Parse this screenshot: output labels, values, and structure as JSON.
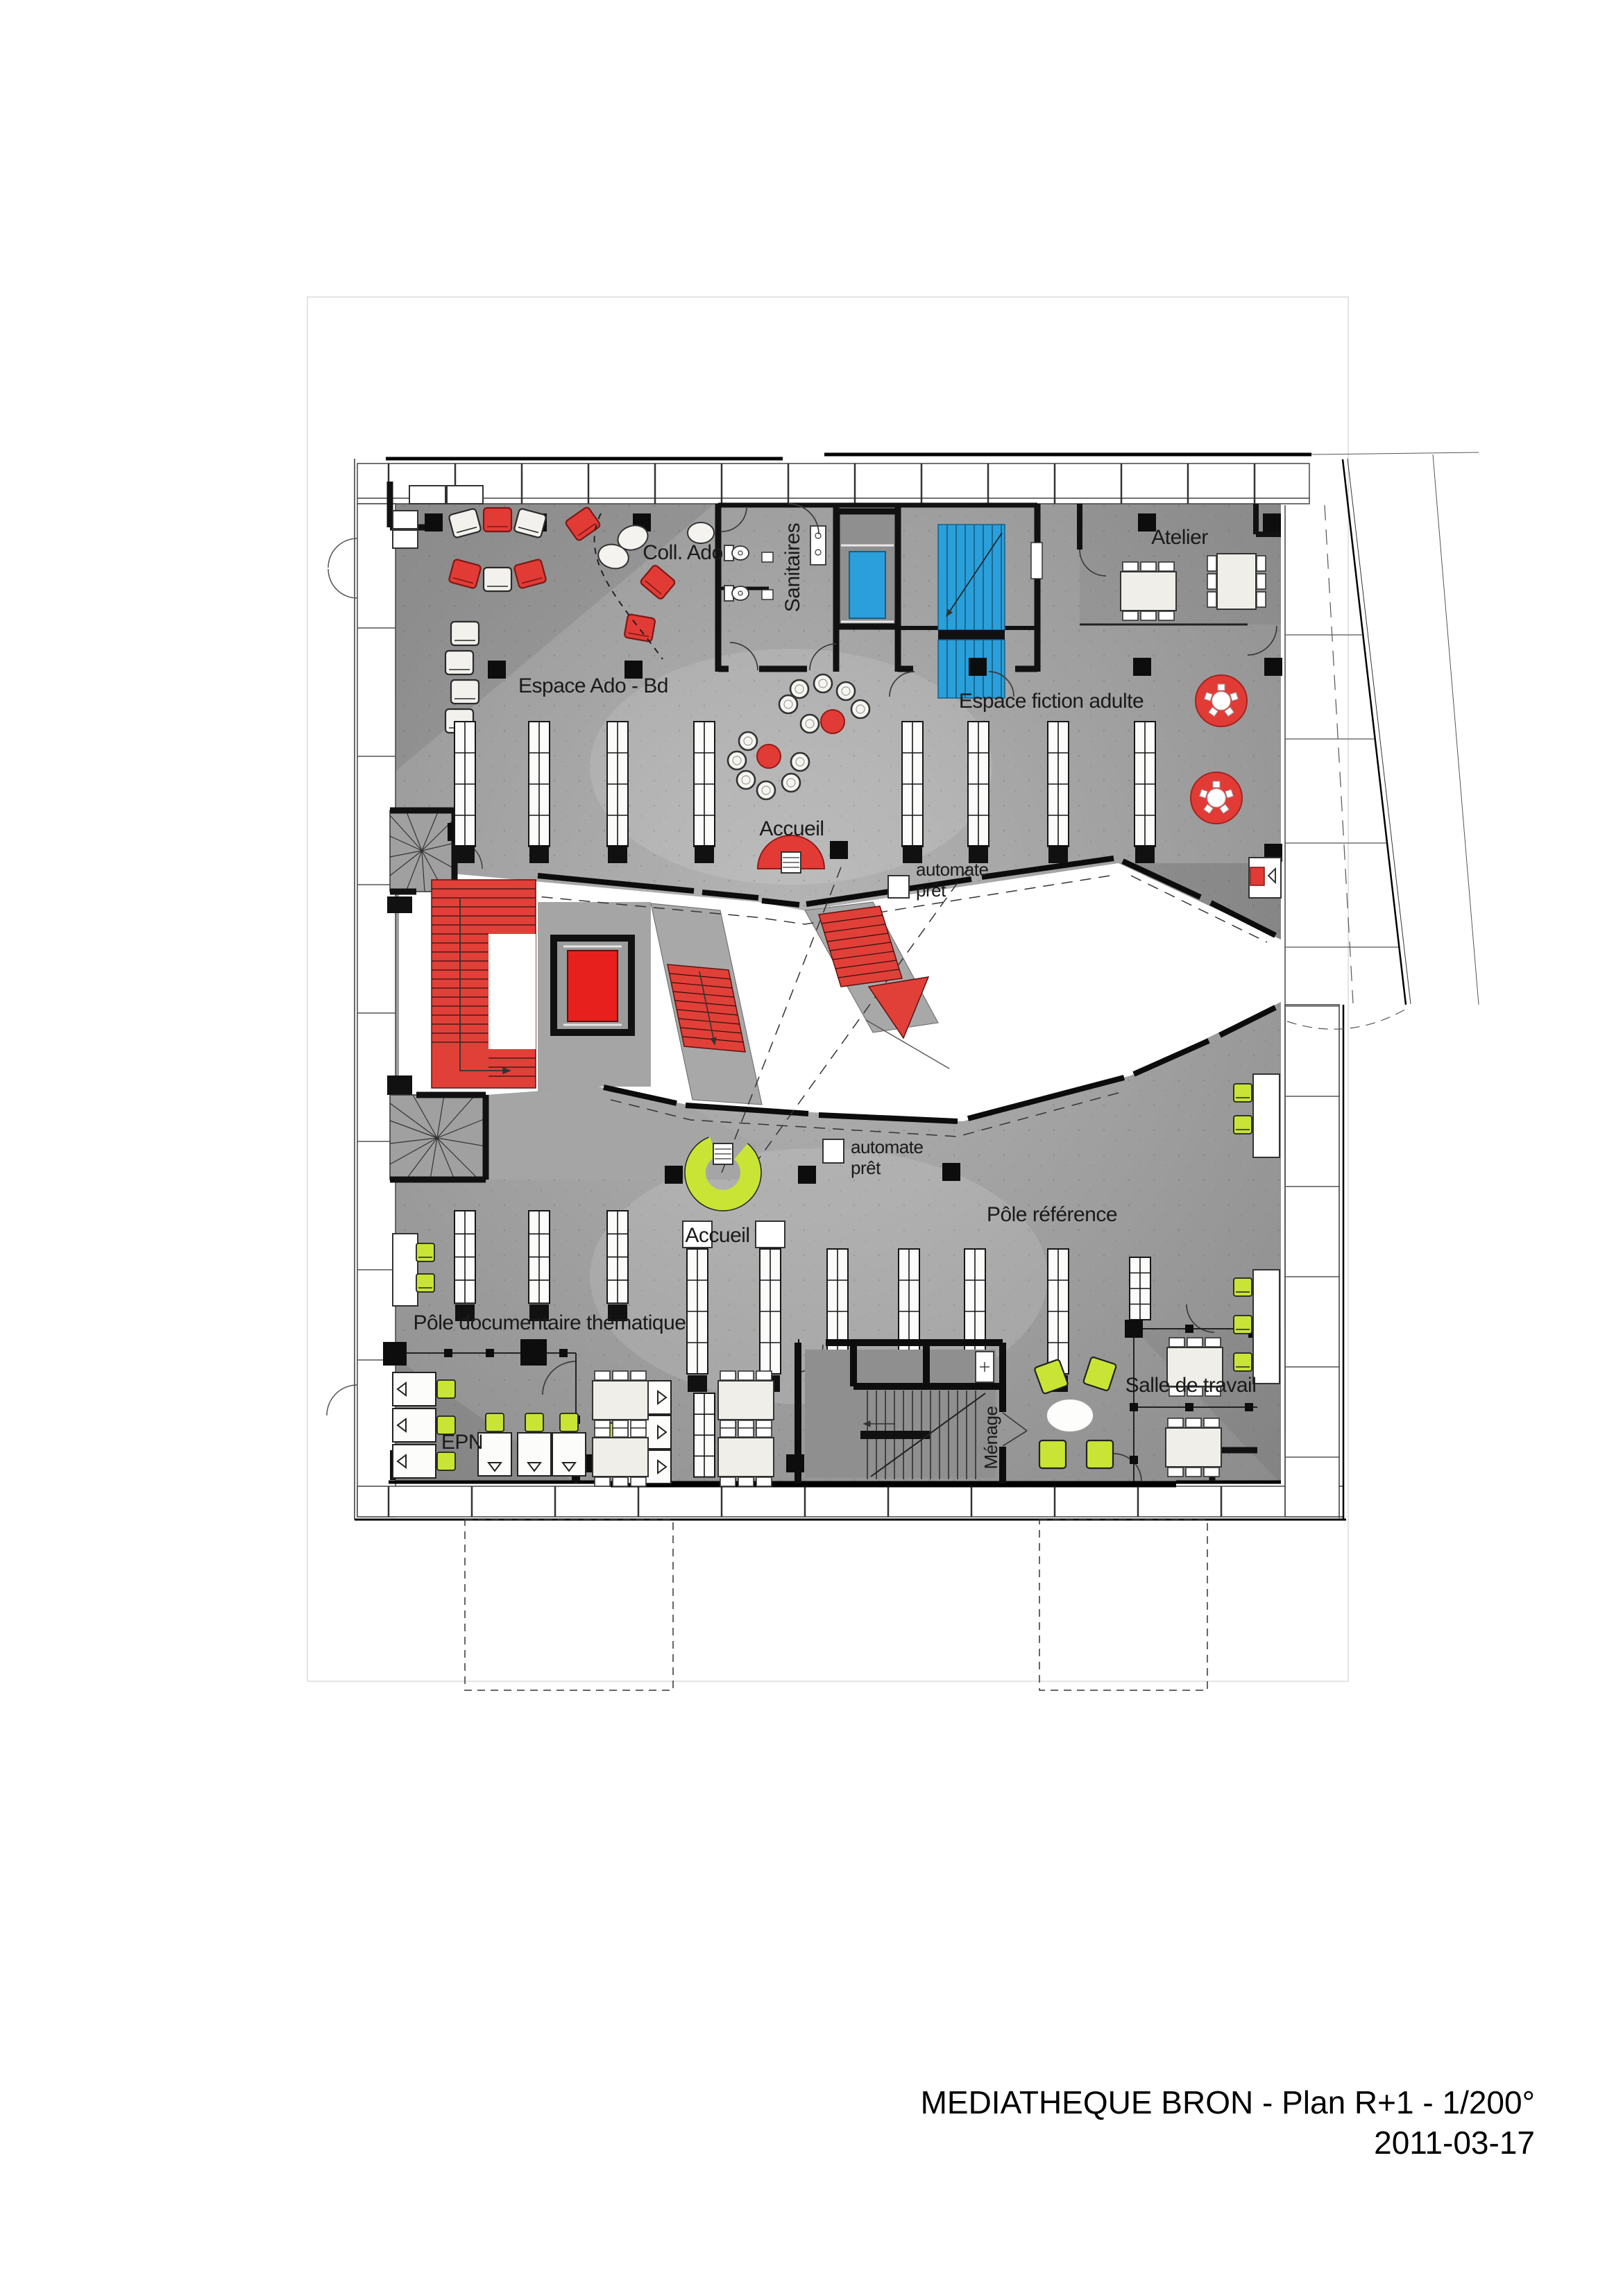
{
  "document": {
    "title": "MEDIATHEQUE BRON - Plan R+1 - 1/200°",
    "date": "2011-03-17"
  },
  "plan": {
    "labels": {
      "espace_ado_bd": "Espace Ado - Bd",
      "coll_ado": "Coll. Ado",
      "sanitaires": "Sanitaires",
      "atelier": "Atelier",
      "espace_fiction_adulte": "Espace fiction adulte",
      "accueil_upper": "Accueil",
      "accueil_lower": "Accueil",
      "automate_pret_line1": "automate",
      "automate_pret_line2": "prêt",
      "pole_reference": "Pôle référence",
      "pole_documentaire": "Pôle documentaire thématique",
      "epn": "EPN",
      "menage": "Ménage",
      "salle_de_travail": "Salle de travail"
    },
    "colors": {
      "floor_gray": "#9b9b9b",
      "wall_black": "#111111",
      "stair_red": "#e23b36",
      "core_blue": "#2b9fd9",
      "furniture_green": "#c9e435",
      "furniture_white": "#f6f5f1"
    }
  }
}
